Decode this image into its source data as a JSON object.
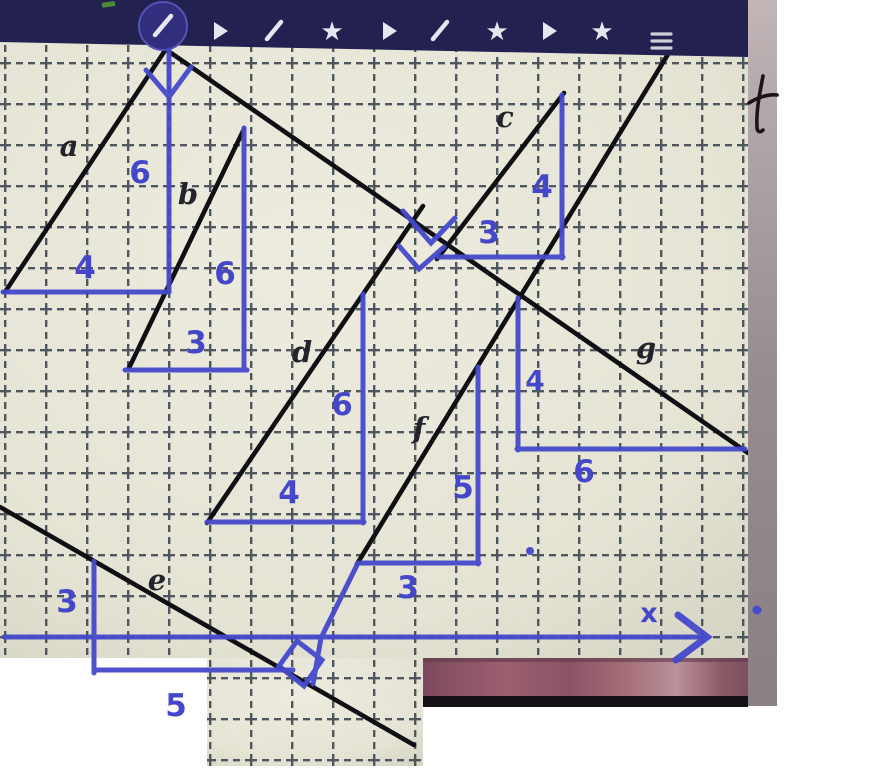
{
  "app": {
    "toolbar": {
      "background": "#232150",
      "icons": [
        {
          "name": "pencil-circle"
        },
        {
          "name": "play"
        },
        {
          "name": "pencil"
        },
        {
          "name": "star"
        },
        {
          "name": "play"
        },
        {
          "name": "pencil"
        },
        {
          "name": "star"
        },
        {
          "name": "play"
        },
        {
          "name": "star"
        },
        {
          "name": "menu"
        }
      ],
      "star_glyph": "★"
    }
  },
  "worksheet": {
    "description": "Photographed worksheet: seven straight lines drawn on dashed grid paper, each with a blue slope triangle annotation",
    "axis_label": "x",
    "handwritten_note": "t",
    "lines": [
      {
        "id": "a",
        "label": "a",
        "rise": "6",
        "run": "4"
      },
      {
        "id": "b",
        "label": "b",
        "rise": "6",
        "run": "3"
      },
      {
        "id": "c",
        "label": "c",
        "rise": "4",
        "run": "3"
      },
      {
        "id": "d",
        "label": "d",
        "rise": "6",
        "run": "4"
      },
      {
        "id": "e",
        "label": "e",
        "rise": "3",
        "run": "5"
      },
      {
        "id": "f",
        "label": "f",
        "rise": "5",
        "run": "3"
      },
      {
        "id": "g",
        "label": "g",
        "rise": "4",
        "run": "6"
      }
    ],
    "ink_marks": [
      "down-arrow on line a rise",
      "right-angle mark where d meets g",
      "right-angle mark where f meets e",
      "stray dot near f triangle",
      "stray dot on right strip"
    ],
    "colors": {
      "ink_blue": "#4549cb",
      "pen_black": "#101014",
      "paper": "#e9e8da",
      "grid": "#434a56",
      "desk_pink": "#9c5f70",
      "photo_strip_gray": "#968b8f"
    }
  }
}
